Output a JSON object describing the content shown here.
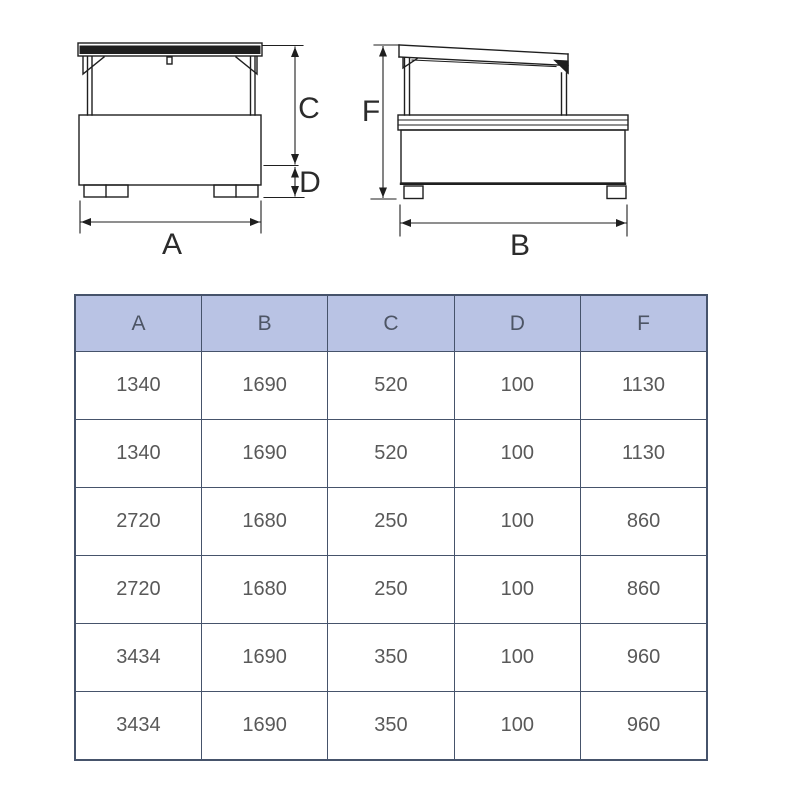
{
  "drawing": {
    "line_color": "#1f1f1f",
    "front_view": {
      "width_label": "A",
      "upper_height_label": "C",
      "lower_height_label": "D"
    },
    "side_view": {
      "width_label": "B",
      "height_label": "F"
    }
  },
  "table": {
    "header_bg": "#b9c3e4",
    "border_color": "#46536b",
    "header_text_color": "#4d5565",
    "cell_text_color": "#595959",
    "headers": [
      "A",
      "B",
      "C",
      "D",
      "F"
    ],
    "rows": [
      [
        "1340",
        "1690",
        "520",
        "100",
        "1130"
      ],
      [
        "1340",
        "1690",
        "520",
        "100",
        "1130"
      ],
      [
        "2720",
        "1680",
        "250",
        "100",
        "860"
      ],
      [
        "2720",
        "1680",
        "250",
        "100",
        "860"
      ],
      [
        "3434",
        "1690",
        "350",
        "100",
        "960"
      ],
      [
        "3434",
        "1690",
        "350",
        "100",
        "960"
      ]
    ]
  }
}
